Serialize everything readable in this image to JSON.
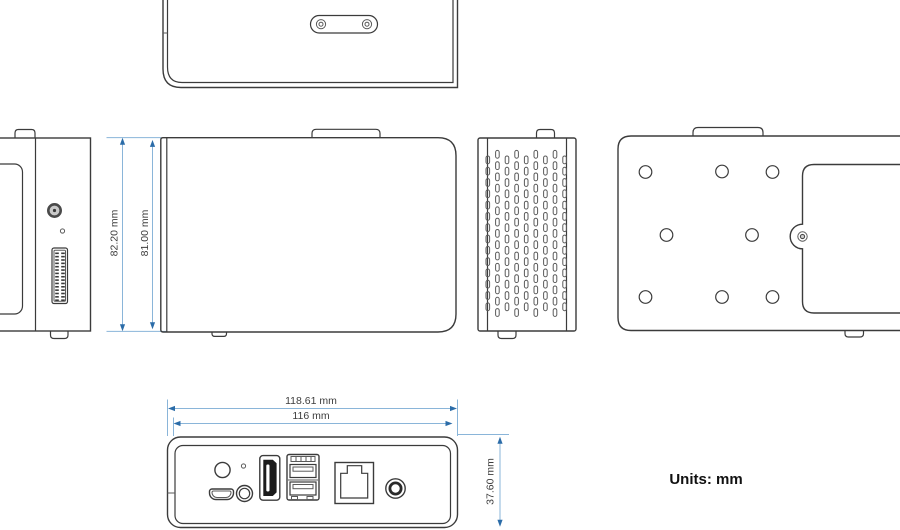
{
  "units_note": "Units: mm",
  "dimensions": {
    "height_outer": "82.20 mm",
    "height_inner": "81.00 mm",
    "width_outer": "118.61 mm",
    "width_inner": "116 mm",
    "depth": "37.60 mm"
  },
  "colors": {
    "background": "#ffffff",
    "line": "#3b3b3b",
    "line_light": "#5a5a5a",
    "dim_line": "#8ab5d9",
    "dim_arrow": "#2b6ca8",
    "dim_text": "#3d3d3d",
    "text": "#111111",
    "port_dark": "#1b1b1b"
  },
  "views": {
    "top": "top view with mounting pill and two screws",
    "left_side": "left side view with screw, hole and pin connector",
    "front": "front view",
    "vent_side": "right side view with ventilation slots",
    "bottom": "bottom view with mounting holes and service door",
    "rear": "rear port view: power button, led, micro-usb, jack, hdmi, dual usb, ethernet, dc-in"
  },
  "vent": {
    "x0": 486,
    "col_pitch": 9.6,
    "columns": 9,
    "slot_w": 3.6,
    "slot_h": 7.8,
    "row_pitch": 11.3,
    "rows_tall": 15,
    "rows_short": 14,
    "y_high": 150.4,
    "y_low": 156.0
  },
  "bottom_holes": [
    [
      645.5,
      172
    ],
    [
      722,
      171.5
    ],
    [
      772.5,
      172
    ],
    [
      666.5,
      235
    ],
    [
      752,
      235
    ],
    [
      645.5,
      297
    ],
    [
      722,
      297
    ],
    [
      772.5,
      297
    ]
  ],
  "connector_pins": {
    "rows": 15,
    "y0": 252.5,
    "pitch": 3.35
  }
}
